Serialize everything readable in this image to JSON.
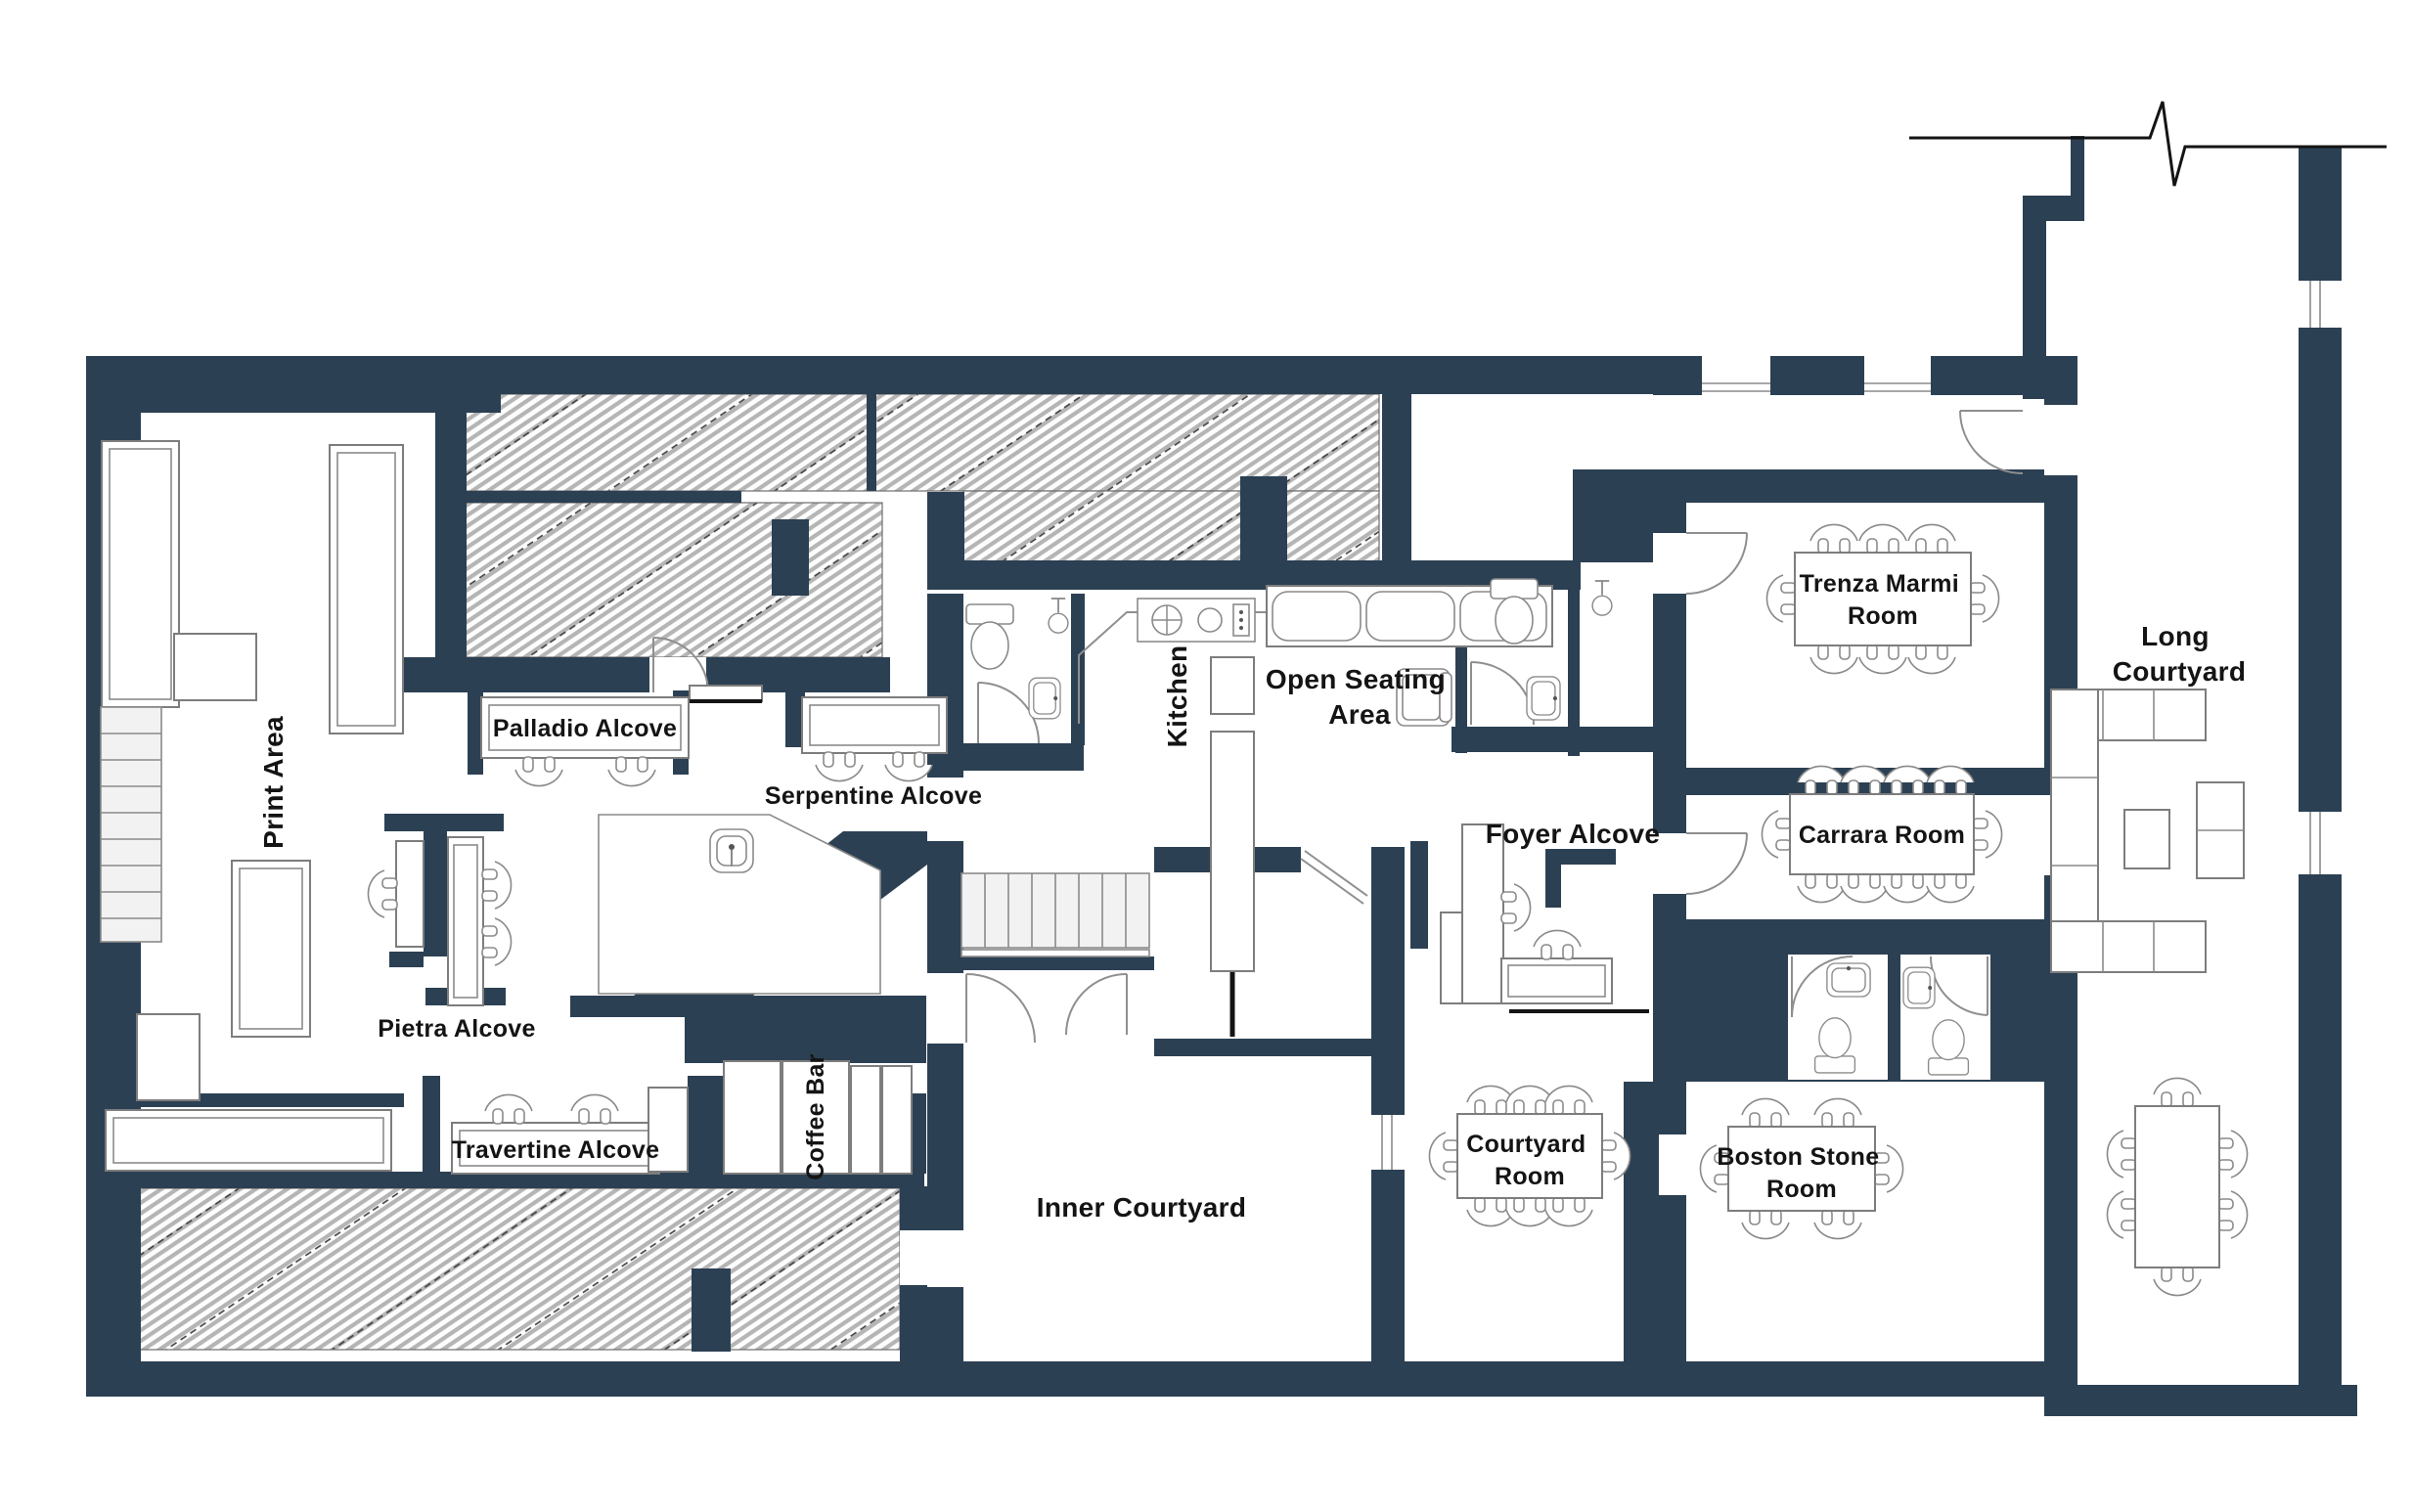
{
  "plan_type": "office-floor-plan",
  "colors": {
    "wall": "#2C4053",
    "hatch_line": "#B5B5B5",
    "hatch_accent": "#3C3C3C",
    "furniture_outline": "#7D7D7D",
    "label_text": "#141414",
    "background": "#FFFFFF"
  },
  "labels": {
    "print_area": "Print Area",
    "palladio_alcove": "Palladio Alcove",
    "serpentine_alcove": "Serpentine Alcove",
    "pietra_alcove": "Pietra Alcove",
    "travertine_alcove": "Travertine Alcove",
    "coffee_bar": "Coffee Bar",
    "kitchen": "Kitchen",
    "open_seating": [
      "Open Seating",
      "Area"
    ],
    "inner_courtyard": "Inner Courtyard",
    "foyer_alcove": "Foyer Alcove",
    "courtyard_room": [
      "Courtyard",
      "Room"
    ],
    "boston_stone_room": [
      "Boston Stone",
      "Room"
    ],
    "carrara_room": "Carrara Room",
    "trenza_marmi_room": [
      "Trenza Marmi",
      "Room"
    ],
    "long_courtyard": [
      "Long",
      "Courtyard"
    ]
  }
}
